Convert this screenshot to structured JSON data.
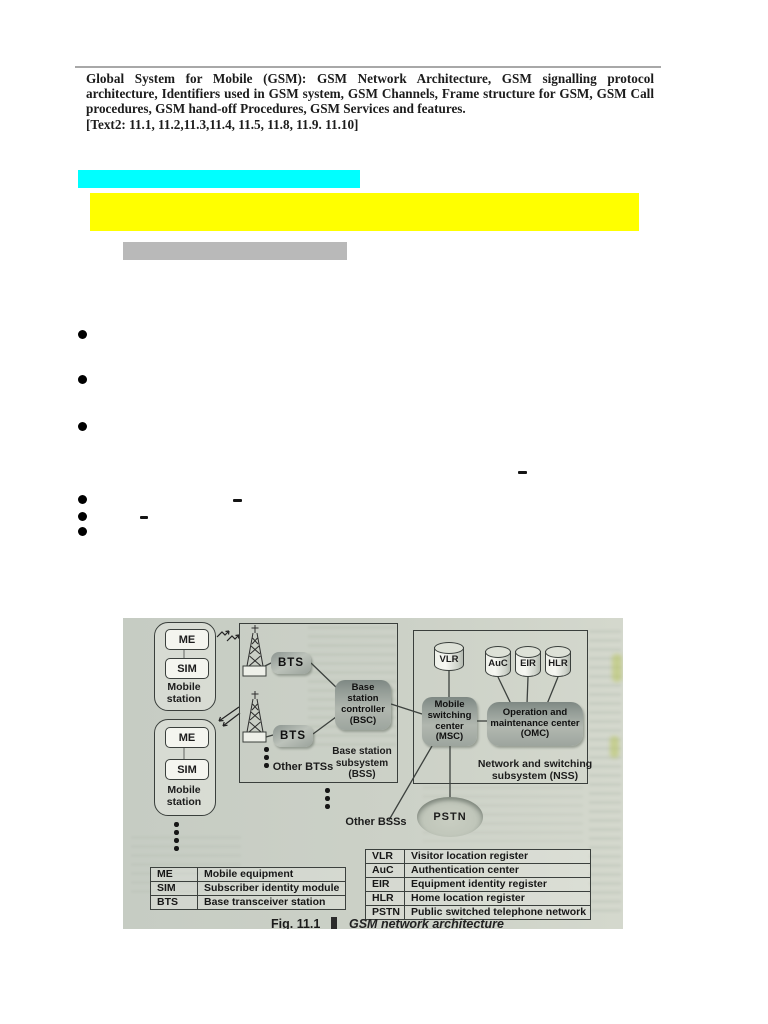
{
  "header": {
    "paragraph": "Global System for Mobile (GSM): GSM Network Architecture, GSM signalling protocol architecture, Identifiers used in GSM system, GSM Channels, Frame structure for GSM, GSM Call procedures, GSM hand-off Procedures, GSM Services and features.",
    "ref_line": "[Text2: 11.1, 11.2,11.3,11.4, 11.5, 11.8, 11.9. 11.10]"
  },
  "highlights": {
    "cyan": "#00FFFF",
    "yellow": "#FFFF00",
    "gray": "#B9B9B9"
  },
  "figure": {
    "mobile_station_1": {
      "me": "ME",
      "sim": "SIM",
      "label": "Mobile\nstation"
    },
    "mobile_station_2": {
      "me": "ME",
      "sim": "SIM",
      "label": "Mobile\nstation"
    },
    "bts_1": "BTS",
    "bts_2": "BTS",
    "other_btss": "Other BTSs",
    "bsc": "Base\nstation\ncontroller\n(BSC)",
    "bss_label": "Base station\nsubsystem\n(BSS)",
    "vlr": "VLR",
    "auc": "AuC",
    "eir": "EIR",
    "hlr": "HLR",
    "msc": "Mobile\nswitching\ncenter\n(MSC)",
    "omc": "Operation and\nmaintenance center\n(OMC)",
    "nss_label": "Network and switching\nsubsystem (NSS)",
    "pstn": "PSTN",
    "other_bsss": "Other BSSs",
    "legend_left": [
      {
        "abbr": "ME",
        "full": "Mobile equipment"
      },
      {
        "abbr": "SIM",
        "full": "Subscriber identity module"
      },
      {
        "abbr": "BTS",
        "full": "Base transceiver station"
      }
    ],
    "legend_right": [
      {
        "abbr": "VLR",
        "full": "Visitor location register"
      },
      {
        "abbr": "AuC",
        "full": "Authentication center"
      },
      {
        "abbr": "EIR",
        "full": "Equipment identity register"
      },
      {
        "abbr": "HLR",
        "full": "Home location register"
      },
      {
        "abbr": "PSTN",
        "full": "Public switched telephone network"
      }
    ],
    "caption": {
      "fig_label": "Fig. 11.1",
      "title": "GSM network architecture"
    }
  }
}
